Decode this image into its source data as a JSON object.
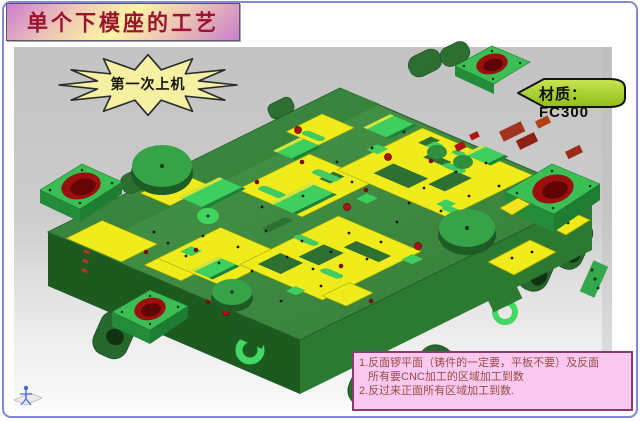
{
  "slide": {
    "title": "单个下模座的工艺",
    "step_burst_label": "第一次上机",
    "material_label": "材质：FC300",
    "notes": {
      "line1": "1.反面锣平面（铸件的一定要，平板不要）及反面",
      "line2": "所有要CNC加工的区域加工到数",
      "line3": "2.反过来正面所有区域加工到数."
    }
  },
  "icons": {
    "csys_triad": "stick-figure-coordinate-triad",
    "burst_shape": "explosion-star",
    "material_shape": "left-arrow-tag"
  },
  "colors": {
    "slide_border_blue": "#8189d4",
    "title_text": "#9c1330",
    "title_gradient_purple": "#cf7ecf",
    "title_gradient_yellow": "#fdf4a4",
    "burst_fill": "#f6f0a2",
    "material_fill_green": "#a9d22f",
    "notes_bg_pink": "#f9c9f1",
    "notes_border": "#8d3a6b",
    "notes_text": "#9c4a40",
    "viewport_gray": "#c4c4c4",
    "model_green": "#3e8e42",
    "model_bright_green": "#3ecf5e",
    "machined_yellow": "#f0ec1c",
    "bore_red": "#9c0f0f"
  }
}
